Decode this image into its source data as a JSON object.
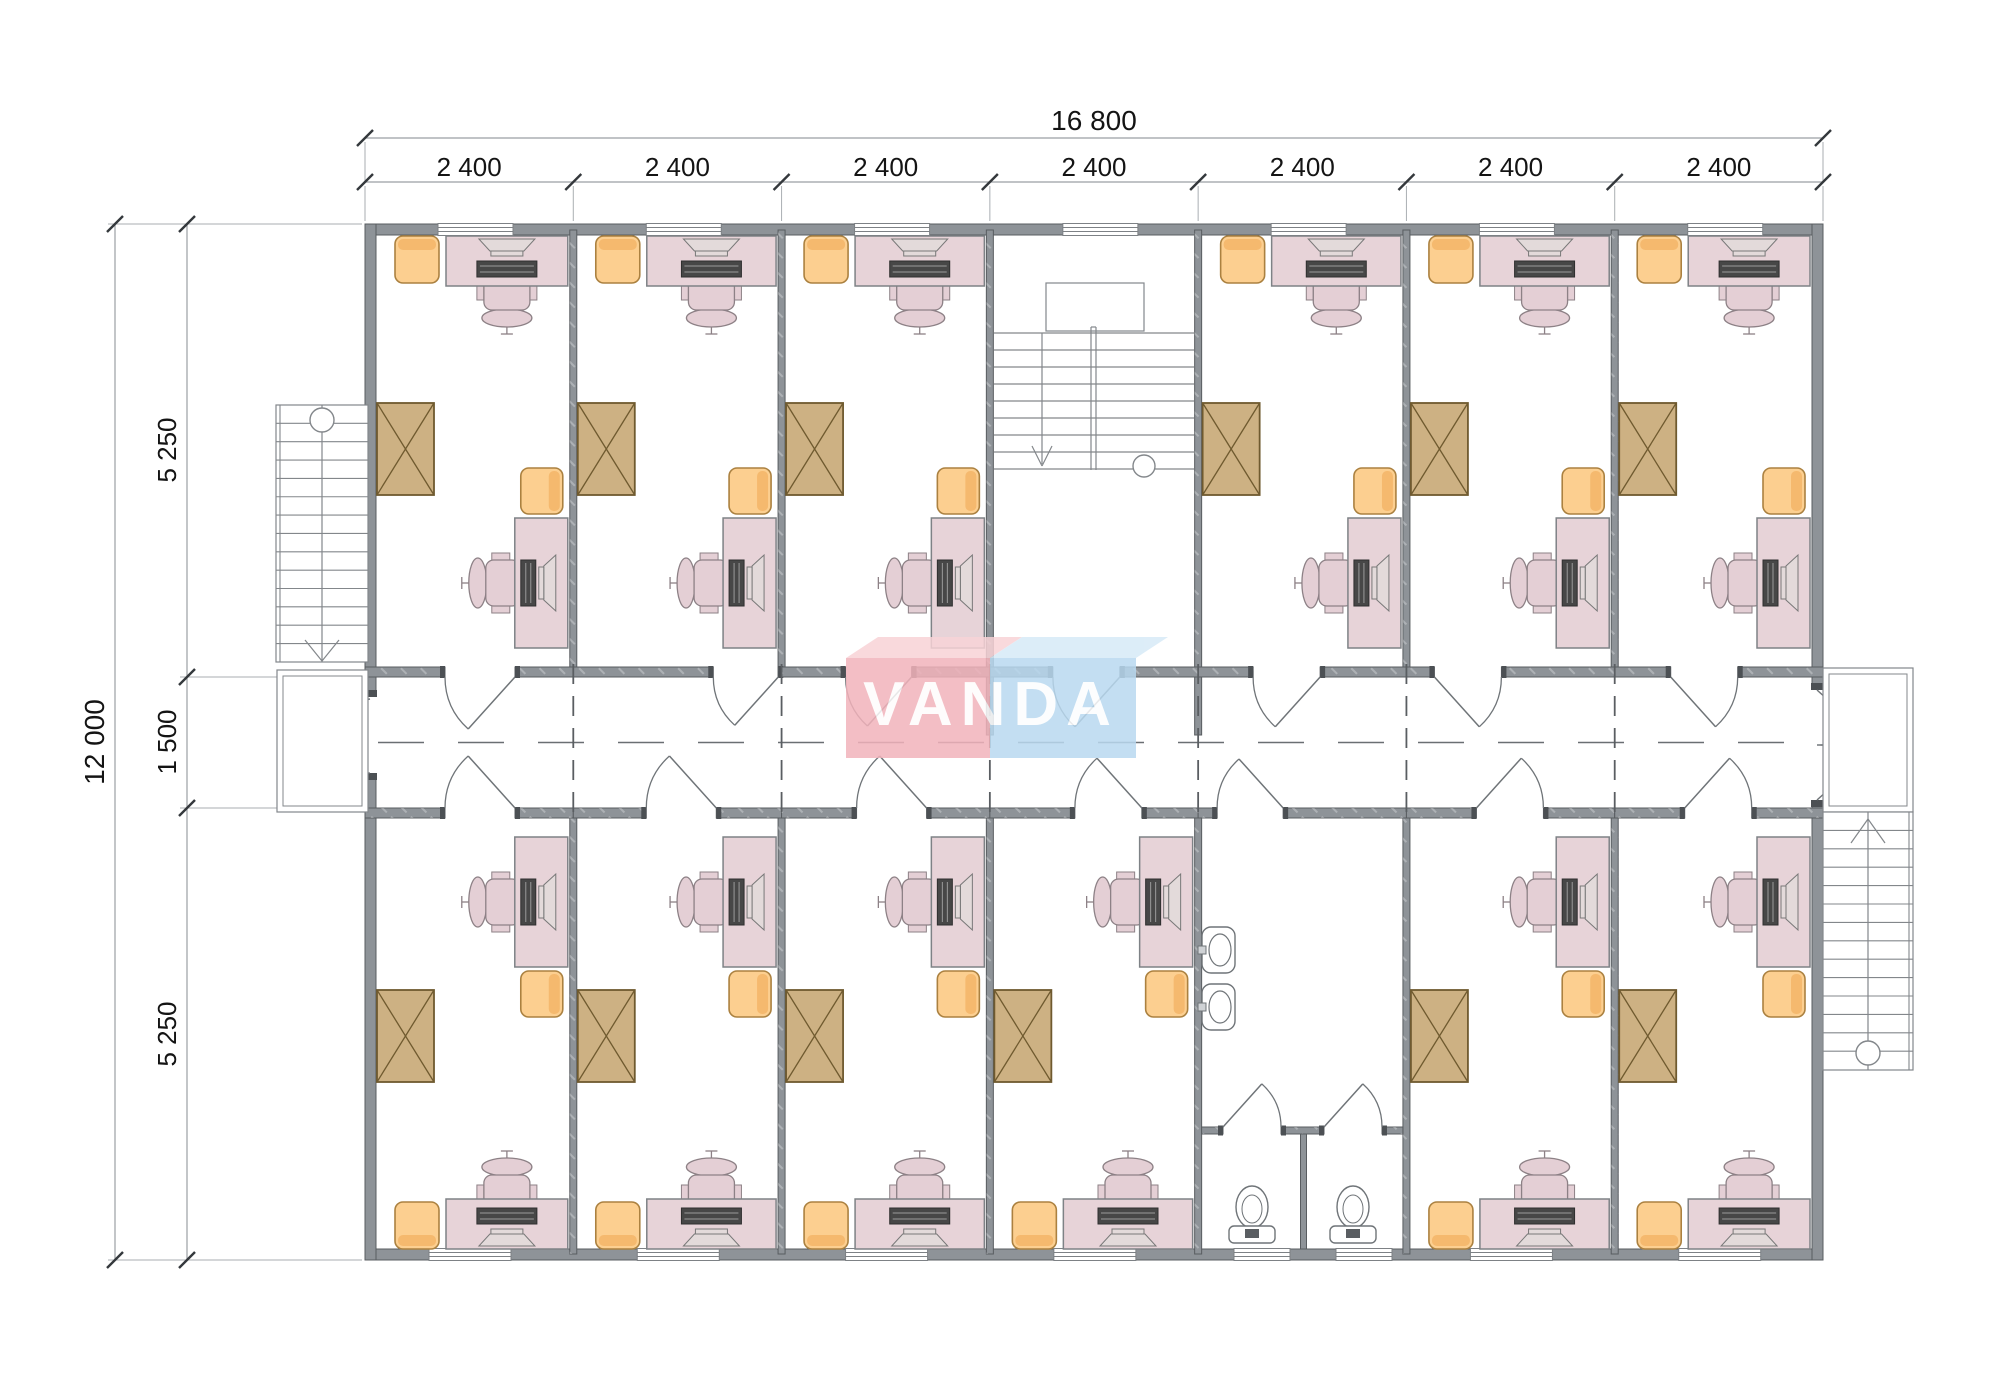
{
  "title": "Modular office block floor plan",
  "watermark": {
    "text": "VANDA",
    "front_left_color": "#f2b3bb",
    "front_right_color": "#b9d9f0",
    "top_left_color": "#f8d3d7",
    "top_right_color": "#d7eaf7",
    "text_color": "#ffffff"
  },
  "dimensions": {
    "top_total": "16 800",
    "top_segments": [
      "2 400",
      "2 400",
      "2 400",
      "2 400",
      "2 400",
      "2 400",
      "2 400"
    ],
    "left_total": "12 000",
    "left_segments": [
      "5 250",
      "1 500",
      "5 250"
    ]
  },
  "layout": {
    "top_row": [
      "office",
      "office",
      "office",
      "stairwell",
      "office",
      "office",
      "office"
    ],
    "bottom_row": [
      "office",
      "office",
      "office",
      "office",
      "bathroom",
      "office",
      "office"
    ],
    "corridor": "central corridor with dashed axis line",
    "exterior_stairs": [
      "left stair with landing",
      "right stair with landing"
    ]
  },
  "colors": {
    "wall": "#8e9398",
    "wall_edge": "#585c60",
    "jamb": "#4c5054",
    "desk": "#e7d3d8",
    "desk_edge": "#7e8286",
    "chair": "#e4cfd5",
    "chair_edge": "#8d8186",
    "armchair": "#fccf90",
    "armchair_back": "#f5b96e",
    "armchair_edge": "#ab8140",
    "wardrobe": "#cdb183",
    "wardrobe_edge": "#6f5a2f",
    "stair_line": "#83878b",
    "dim_line": "#9b9fa3",
    "dim_text": "#141414",
    "tick": "#34383c",
    "door": "#6f7478",
    "fixture": "#6f7478",
    "dash": "#6a6f73",
    "monitor": "#e3dada",
    "keyboard": "#474747",
    "window_line": "#7d8185"
  }
}
